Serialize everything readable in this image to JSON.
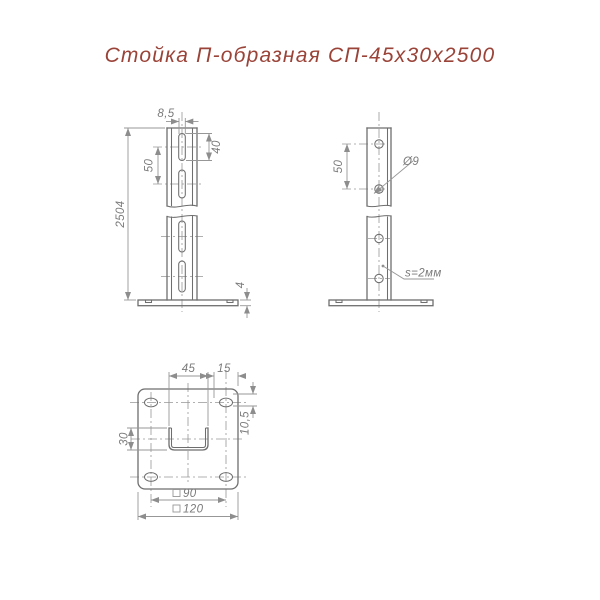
{
  "title": "Стойка П-образная СП-45х30х2500",
  "colors": {
    "title_text": "#9a4338",
    "object_line": "#6e6e6e",
    "dimension_line": "#979797",
    "dimension_text": "#7a7a7a",
    "background": "#ffffff"
  },
  "front_view": {
    "dim_slot_width": "8,5",
    "dim_slot_length": "40",
    "dim_slot_spacing": "50",
    "dim_total_height": "2504",
    "dim_plate_thickness": "4"
  },
  "side_view": {
    "dim_hole_spacing": "50",
    "hole_diameter_label": "Ø9",
    "wall_thickness_label": "s=2мм"
  },
  "bottom_view": {
    "dim_channel_width": "45",
    "dim_edge_offset": "15",
    "dim_hole_height": "10,5",
    "dim_channel_depth": "30",
    "dim_hole_square": "90",
    "dim_plate_square": "120"
  }
}
